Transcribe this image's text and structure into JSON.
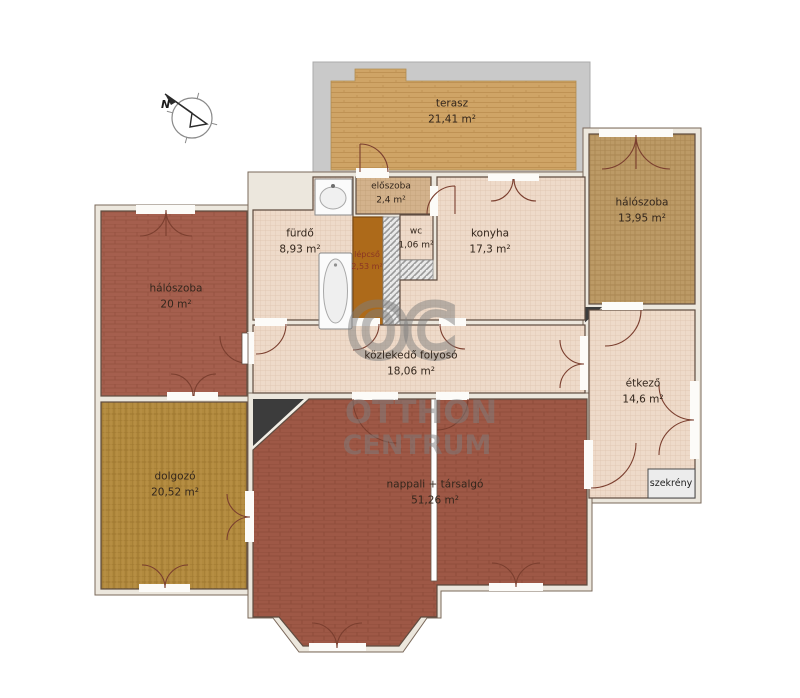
{
  "watermark": {
    "monogram": "OC",
    "line1": "OTTHON",
    "line2": "CENTRUM"
  },
  "compass": {
    "north_label": "N"
  },
  "rooms": {
    "terasz": {
      "name": "terasz",
      "area": "21,41 m²"
    },
    "halo13": {
      "name": "hálószoba",
      "area": "13,95 m²"
    },
    "halo20": {
      "name": "hálószoba",
      "area": "20 m²"
    },
    "furdo": {
      "name": "fürdő",
      "area": "8,93 m²"
    },
    "eloszoba": {
      "name": "előszoba",
      "area": "2,4 m²"
    },
    "lepcso": {
      "name": "lépcső",
      "area": "2,53 m²"
    },
    "wc": {
      "name": "wc",
      "area": "1,06 m²"
    },
    "konyha": {
      "name": "konyha",
      "area": "17,3 m²"
    },
    "folyoso": {
      "name": "közlekedő folyosó",
      "area": "18,06 m²"
    },
    "etkezo": {
      "name": "étkező",
      "area": "14,6 m²"
    },
    "dolgozo": {
      "name": "dolgozó",
      "area": "20,52 m²"
    },
    "nappali": {
      "name": "nappali + társalgó",
      "area": "51,26 m²"
    },
    "szekreny": {
      "name": "szekrény"
    }
  },
  "colors": {
    "terrace_surround": "#c9c9c9",
    "terrace_fill": "#cfa466",
    "bedroom_red": "#a55f4e",
    "living_red": "#9e5846",
    "study_gold": "#b28a3e",
    "bedroom_tan": "#bc9a66",
    "rooms_pink": "#eedac9",
    "hall_tan": "#d3b28c",
    "stairs_orange": "#ad6a1a",
    "wall": "#ece7dd",
    "watermark_gray": "#7d7d7d"
  }
}
